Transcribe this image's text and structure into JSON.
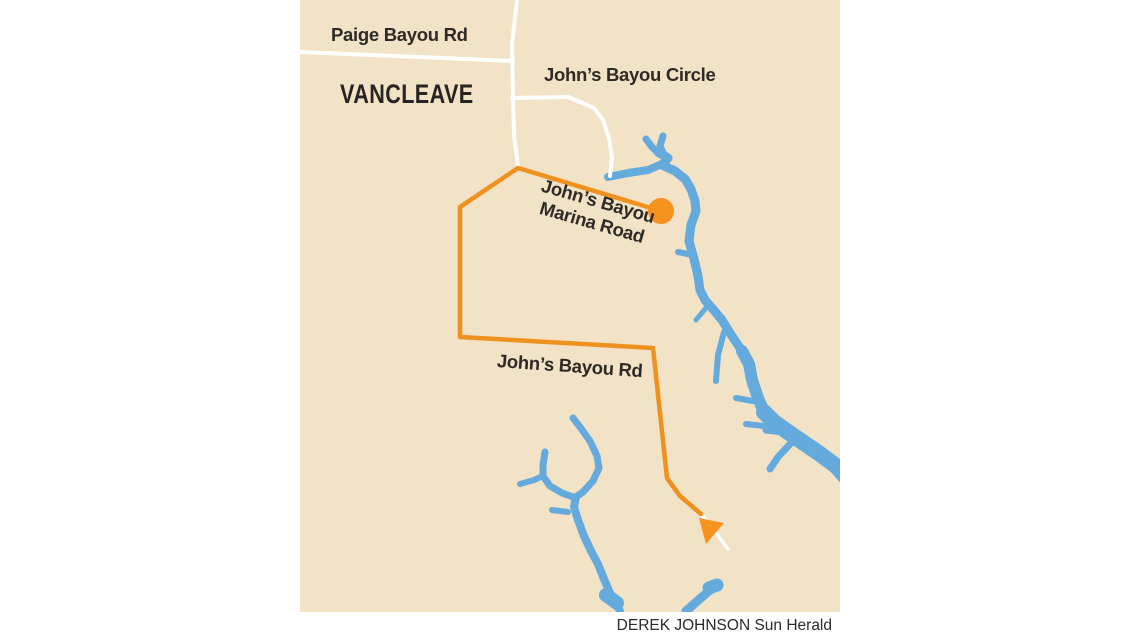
{
  "map": {
    "town_label": "VANCLEAVE",
    "roads": {
      "paige_bayou": "Paige Bayou Rd",
      "johns_bayou_circle": "John’s Bayou Circle",
      "marina_line1": "John’s Bayou",
      "marina_line2": "Marina Road",
      "johns_bayou_rd": "John’s Bayou Rd"
    },
    "colors": {
      "land": "#f2e2c6",
      "water": "#64aadd",
      "road": "#ffffff",
      "highlight_road": "#ef911e",
      "marker": "#f6921e",
      "label_text": "#2e2a26"
    }
  },
  "credit": "DEREK JOHNSON Sun Herald"
}
